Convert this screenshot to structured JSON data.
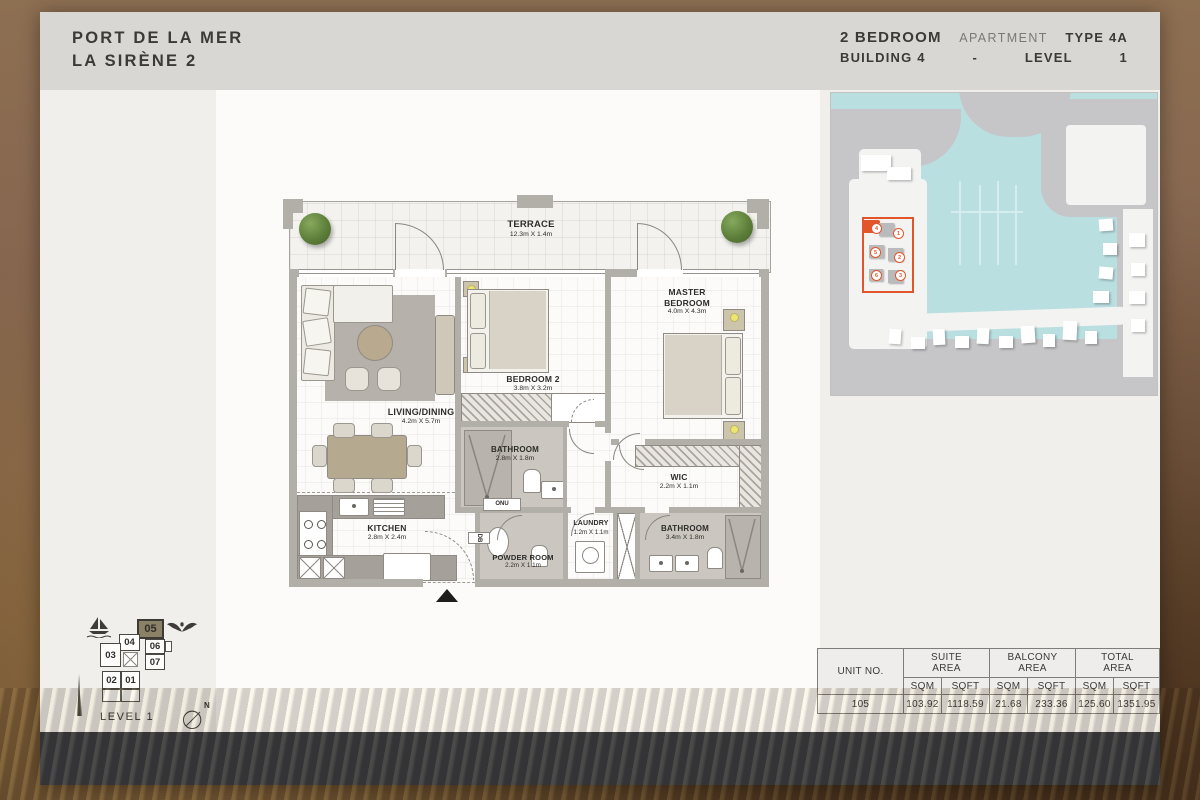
{
  "header": {
    "title_line1": "PORT DE LA MER",
    "title_line2": "LA SIRÈNE 2",
    "bedrooms": "2 BEDROOM",
    "apartment_label": "APARTMENT",
    "type_label": "TYPE 4A",
    "building_label": "BUILDING 4",
    "separator": "-",
    "level_label": "LEVEL",
    "level_value": "1"
  },
  "floorplan": {
    "rooms": [
      {
        "name": "TERRACE",
        "dims": "12.3m X 1.4m"
      },
      {
        "name": "LIVING/DINING",
        "dims": "4.2m X 5.7m"
      },
      {
        "name": "BEDROOM 2",
        "dims": "3.8m X 3.2m"
      },
      {
        "name": "MASTER BEDROOM",
        "dims": "4.0m X 4.3m"
      },
      {
        "name": "BATHROOM",
        "dims": "2.8m X 1.8m"
      },
      {
        "name": "WIC",
        "dims": "2.2m X 1.1m"
      },
      {
        "name": "KITCHEN",
        "dims": "2.8m X 2.4m"
      },
      {
        "name": "POWDER ROOM",
        "dims": "2.2m X 1.1m"
      },
      {
        "name": "LAUNDRY",
        "dims": "1.2m X 1.1m"
      },
      {
        "name": "BATHROOM",
        "dims": "3.4m X 1.8m"
      }
    ],
    "utility_labels": {
      "onu": "ONU",
      "db": "DB"
    }
  },
  "site_map": {
    "numbers": {
      "b1": "1",
      "b2": "2",
      "b3": "3",
      "b4": "4",
      "b5": "5",
      "b6": "6"
    },
    "highlighted_building": "4",
    "highlight_color": "#e2552b"
  },
  "level_diagram": {
    "units": {
      "u01": "01",
      "u02": "02",
      "u03": "03",
      "u04": "04",
      "u05": "05",
      "u06": "06",
      "u07": "07"
    },
    "highlighted_unit": "05",
    "caption": "LEVEL 1",
    "compass_label": "N"
  },
  "area_table": {
    "unit_col_header": "UNIT NO.",
    "group_headers": {
      "suite": "SUITE AREA",
      "balcony": "BALCONY AREA",
      "total": "TOTAL AREA"
    },
    "sub_header_sqm": "SQM",
    "sub_header_sqft": "SQFT",
    "row": {
      "unit_no": "105",
      "suite_sqm": "103.92",
      "suite_sqft": "1118.59",
      "balcony_sqm": "21.68",
      "balcony_sqft": "233.36",
      "total_sqm": "125.60",
      "total_sqft": "1351.95"
    }
  }
}
